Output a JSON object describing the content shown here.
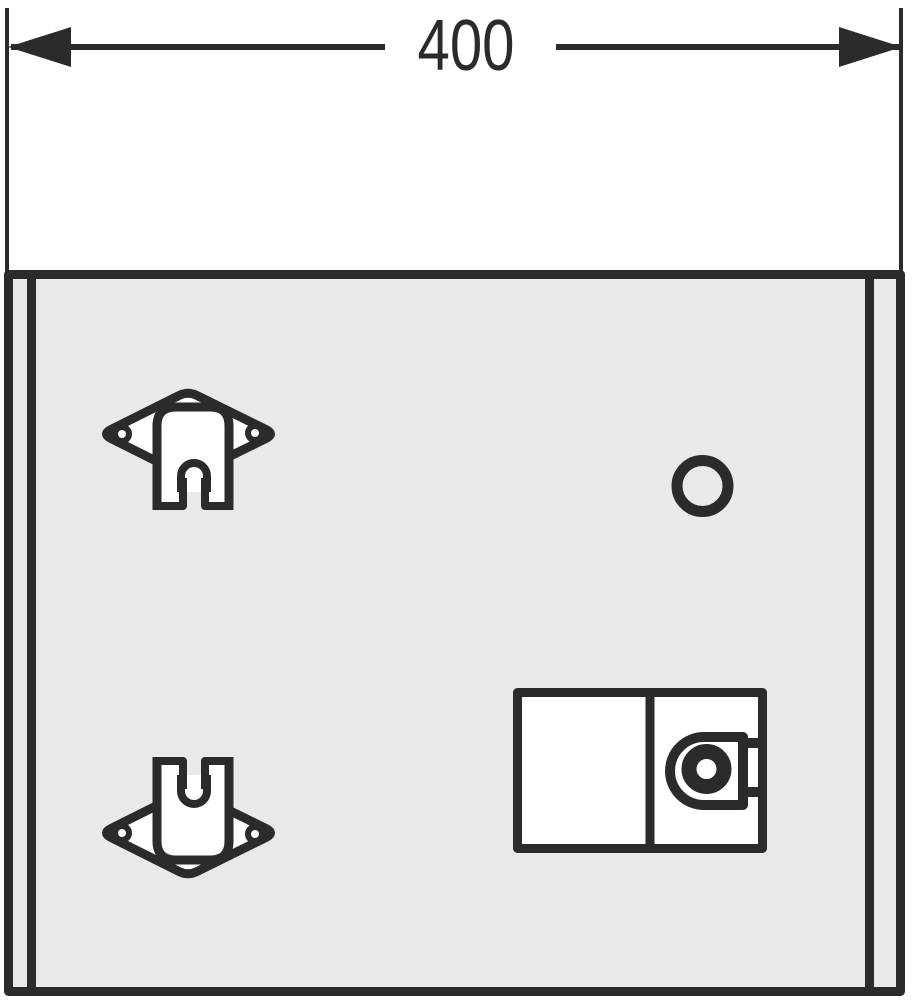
{
  "drawing": {
    "kind": "furniture-front-view-installation-drawing",
    "dimension": {
      "label": "400"
    },
    "colors": {
      "line": "#2b2b2b",
      "panel": "#e9e9e9",
      "white": "#ffffff",
      "page_background": "#ffffff"
    }
  }
}
